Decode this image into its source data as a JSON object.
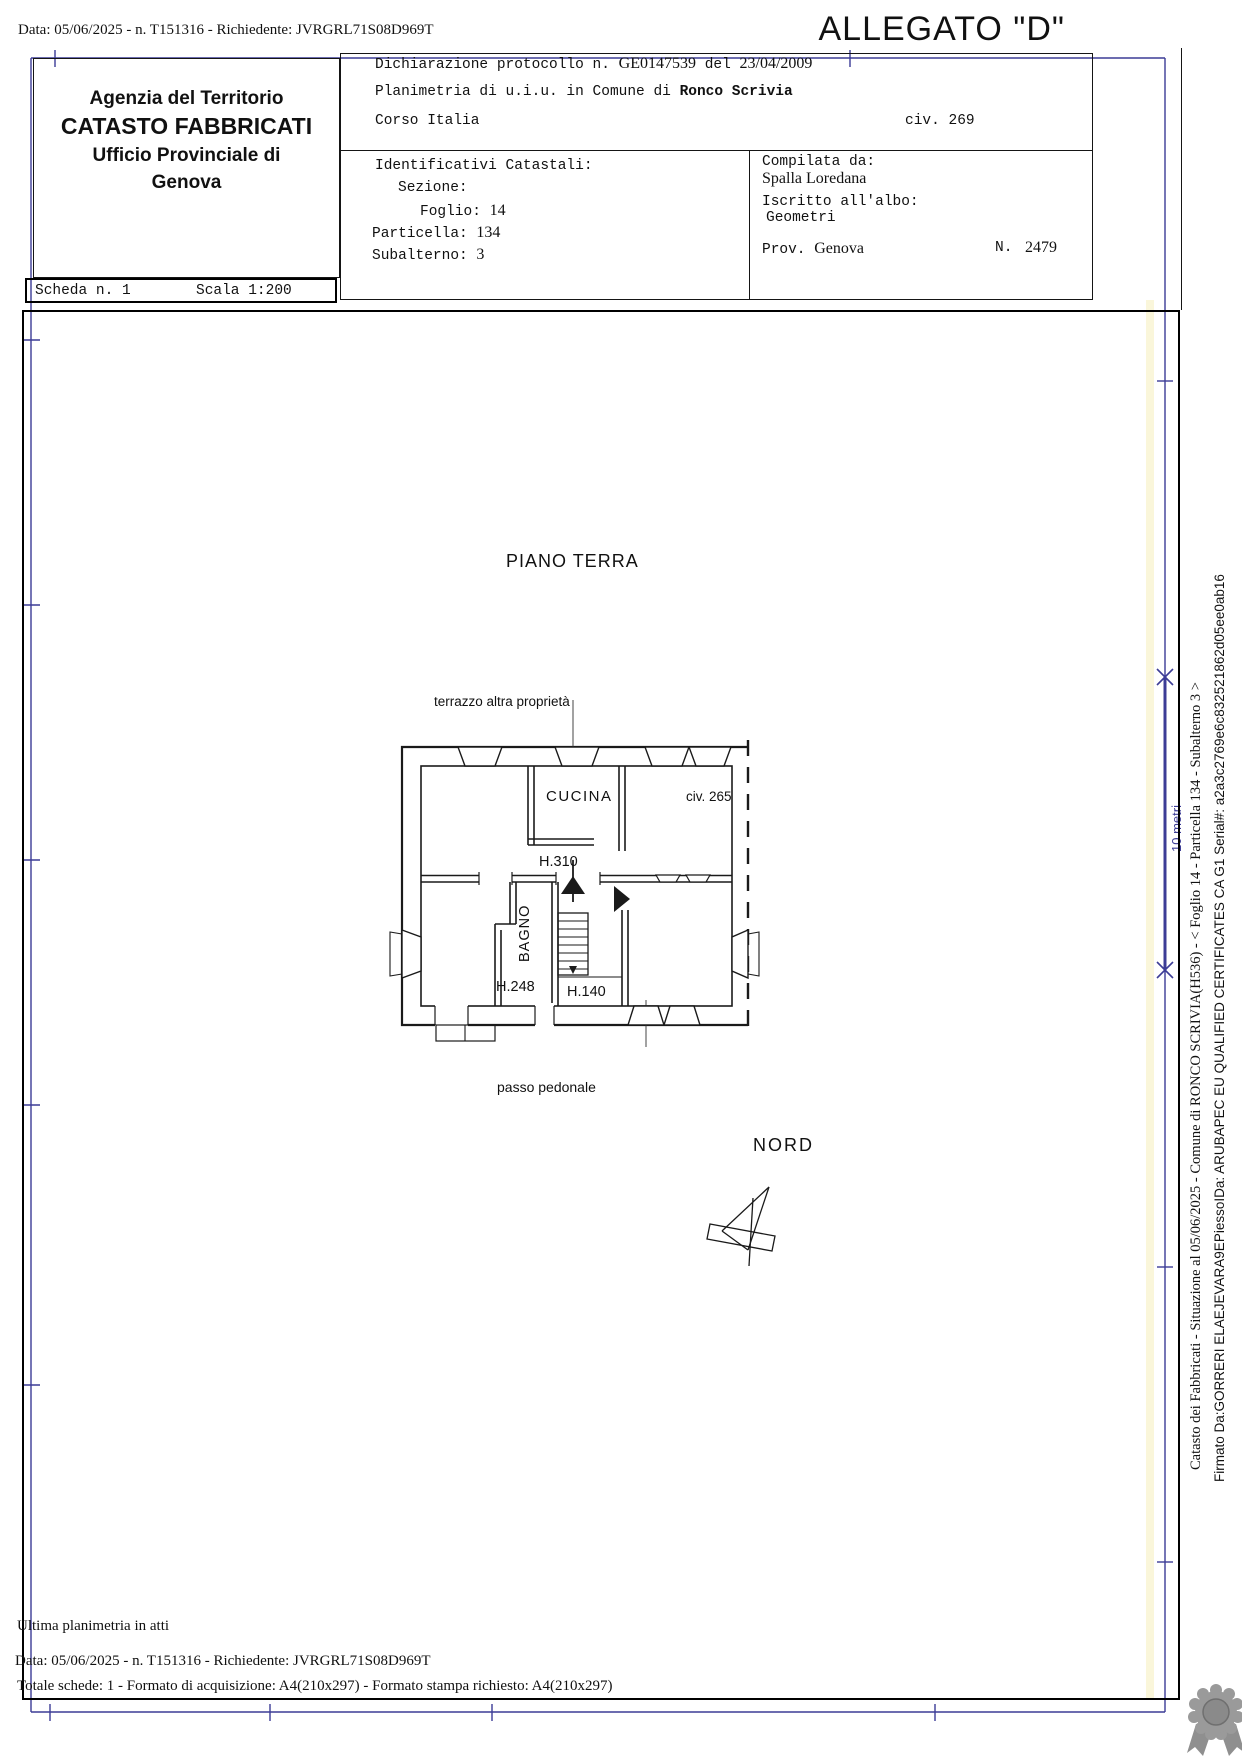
{
  "page": {
    "top_line": "Data: 05/06/2025 - n. T151316 - Richiedente: JVRGRL71S08D969T",
    "allegato": "ALLEGATO \"D\""
  },
  "agency": {
    "line1": "Agenzia del Territorio",
    "line2": "CATASTO FABBRICATI",
    "line3": "Ufficio Provinciale di",
    "line4": "Genova"
  },
  "scheda": {
    "label": "Scheda n. 1",
    "scala": "Scala 1:200"
  },
  "declaration": {
    "protocol_label": "Dichiarazione protocollo n.",
    "protocol_number": "GE0147539",
    "del": "del",
    "date": "23/04/2009",
    "planimetria": "Planimetria di u.i.u. in Comune di",
    "comune": "Ronco Scrivia",
    "street": "Corso Italia",
    "civ": "civ. 269"
  },
  "identificativi": {
    "title": "Identificativi Catastali:",
    "sezione_label": "Sezione:",
    "foglio_label": "Foglio:",
    "foglio": "14",
    "particella_label": "Particella:",
    "particella": "134",
    "subalterno_label": "Subalterno:",
    "subalterno": "3"
  },
  "compilata": {
    "label": "Compilata da:",
    "name": "Spalla Loredana",
    "albo_label": "Iscritto all'albo:",
    "albo": "Geometri",
    "prov_label": "Prov.",
    "prov": "Genova",
    "num_label": "N.",
    "num": "2479"
  },
  "plan": {
    "title": "PIANO TERRA",
    "terrace": "terrazzo altra proprietà",
    "cucina": "CUCINA",
    "h310": "H.310",
    "bagno": "BAGNO",
    "h248": "H.248",
    "h140": "H.140",
    "civ265": "civ. 265",
    "passo": "passo pedonale",
    "nord": "NORD",
    "scalebar": "10 metri"
  },
  "footer": {
    "ultima": "Ultima planimetria in atti",
    "data_line": "Data: 05/06/2025 - n. T151316 - Richiedente: JVRGRL71S08D969T",
    "totale": "Totale schede: 1 - Formato di acquisizione: A4(210x297)  - Formato stampa richiesto: A4(210x297)"
  },
  "margin": {
    "catasto_line": "Catasto dei Fabbricati - Situazione al 05/06/2025 - Comune di RONCO SCRIVIA(H536) - < Foglio 14 - Particella 134 - Subalterno 3 >",
    "firmato_line": "Firmato Da:GORRERI ELAEJEVARA9EPiessoIDa: ARUBAPEC EU QUALIFIED CERTIFICATES CA G1 Serial#: a2a3c2769e6c832521862d05ee0ab16"
  },
  "colors": {
    "frame_blue": "#3c3c96",
    "ink": "#151515",
    "seal_gray": "#8f8f8f"
  }
}
